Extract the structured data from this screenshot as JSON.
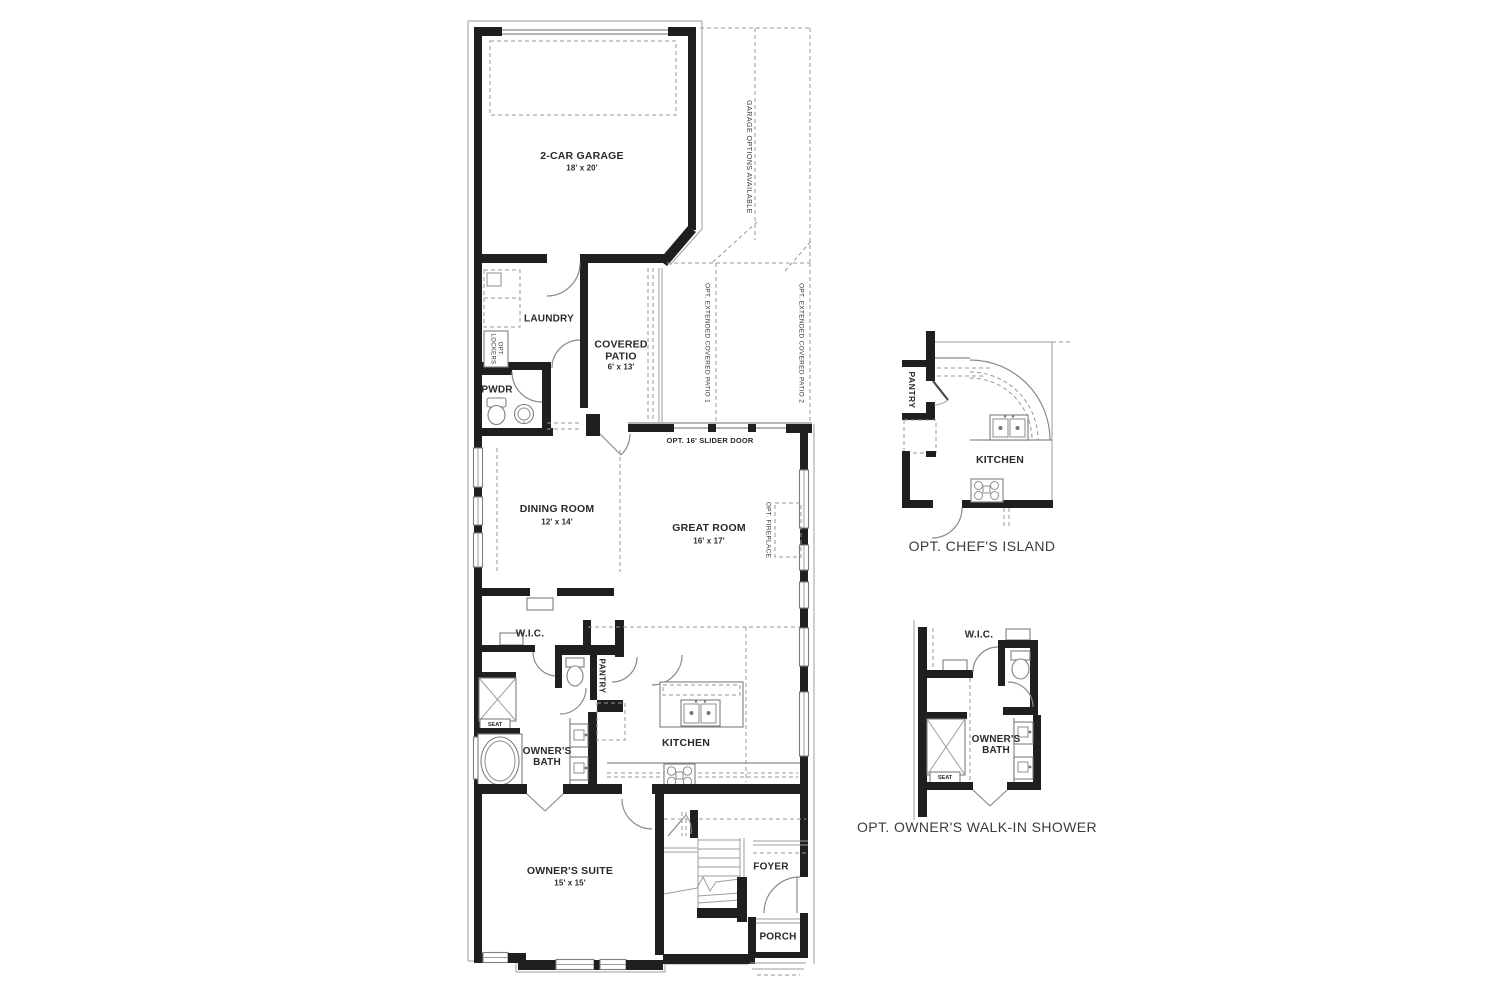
{
  "colors": {
    "wall": "#1f1f1f",
    "thin_line": "#8a8a8a",
    "dashed_line": "#979797",
    "label_text": "#2a2a2a",
    "caption_text": "#3c3c3c",
    "background": "#ffffff"
  },
  "main": {
    "garage_label": "2-CAR GARAGE",
    "garage_dims": "18' x 20'",
    "garage_options": "GARAGE OPTIONS AVAILABLE",
    "laundry": "LAUNDRY",
    "opt_lockers": "OPT. LOCKERS",
    "pwdr": "PWDR",
    "covered_patio": "COVERED PATIO",
    "covered_patio_dims": "6' x 13'",
    "opt_ext_patio_1": "OPT. EXTENDED COVERED PATIO 1",
    "opt_ext_patio_2": "OPT. EXTENDED COVERED PATIO 2",
    "opt_slider_door": "OPT. 16' SLIDER DOOR",
    "dining": "DINING ROOM",
    "dining_dims": "12' x 14'",
    "great_room": "GREAT ROOM",
    "great_room_dims": "16' x 17'",
    "opt_fireplace": "OPT. FIREPLACE",
    "wic": "W.I.C.",
    "pantry": "PANTRY",
    "owners_bath": "OWNER'S BATH",
    "seat": "SEAT",
    "kitchen": "KITCHEN",
    "owners_suite": "OWNER'S SUITE",
    "owners_suite_dims": "15' x 15'",
    "foyer": "FOYER",
    "porch": "PORCH"
  },
  "inset_chefs_island": {
    "caption": "OPT. CHEF'S ISLAND",
    "kitchen": "KITCHEN",
    "pantry": "PANTRY"
  },
  "inset_walkin_shower": {
    "caption": "OPT. OWNER'S WALK-IN SHOWER",
    "wic": "W.I.C.",
    "owners_bath": "OWNER'S BATH",
    "seat": "SEAT"
  }
}
